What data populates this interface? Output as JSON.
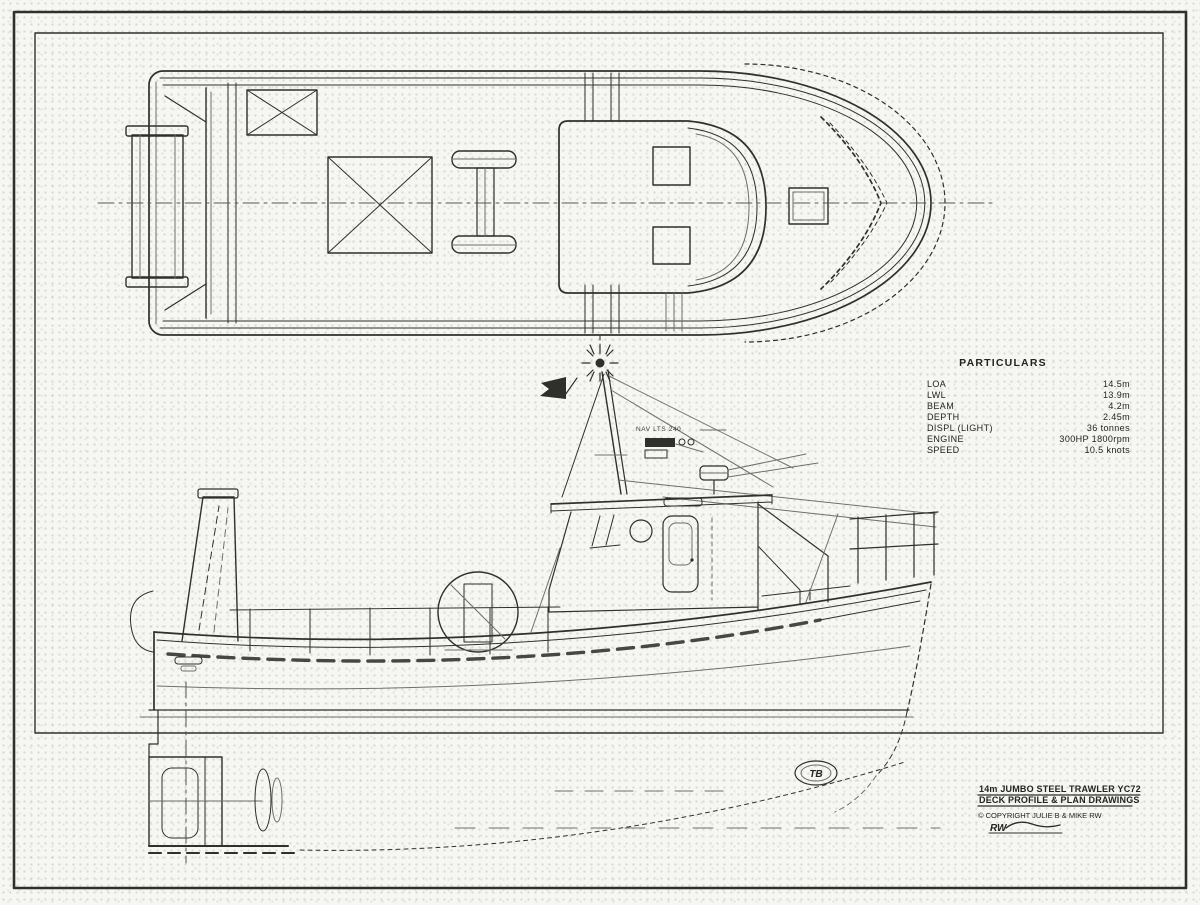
{
  "colors": {
    "ink": "#2f2f2c",
    "paper": "#f6f6f3"
  },
  "particulars": {
    "title": "PARTICULARS",
    "rows": [
      {
        "label": "LOA",
        "value": "14.5m"
      },
      {
        "label": "LWL",
        "value": "13.9m"
      },
      {
        "label": "BEAM",
        "value": "4.2m"
      },
      {
        "label": "DEPTH",
        "value": "2.45m"
      },
      {
        "label": "DISPL (LIGHT)",
        "value": "36 tonnes"
      },
      {
        "label": "ENGINE",
        "value": "300HP 1800rpm"
      },
      {
        "label": "SPEED",
        "value": "10.5 knots"
      }
    ]
  },
  "title_block": {
    "line1": "14m JUMBO STEEL TRAWLER YC72",
    "line2": "DECK PROFILE & PLAN DRAWINGS",
    "copyright": "© COPYRIGHT JULIE B & MIKE RW",
    "signature": "RW"
  },
  "annotations": {
    "mast_note": "NAV LTS 240"
  },
  "logo": {
    "text": "TB"
  }
}
